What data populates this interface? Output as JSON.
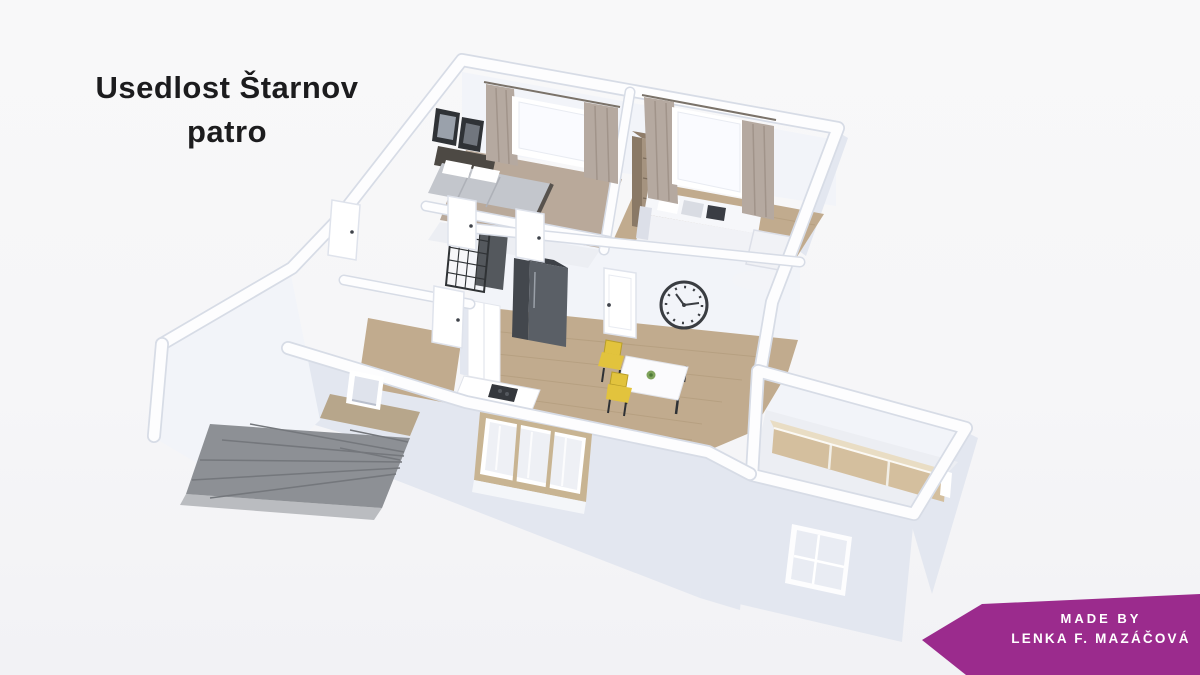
{
  "title": {
    "line1": "Usedlost Štarnov",
    "line2": "patro"
  },
  "credit": {
    "line1": "MADE BY",
    "line2": "LENKA F. MAZÁČOVÁ"
  },
  "scene": {
    "kind": "3d-floor-plan-render",
    "objects": [
      "double-bed",
      "wall-pictures",
      "curtained-windows",
      "bookcase",
      "corner-sofa",
      "rug",
      "glass-grid-partition",
      "wardrobe",
      "fridge",
      "kitchen-cabinets",
      "cooktop-counter",
      "dining-table",
      "yellow-chairs",
      "wall-clock",
      "interior-doors",
      "triple-front-window",
      "staircase",
      "small-wall-window",
      "wooden-sideboard",
      "storage-window"
    ]
  },
  "palette": {
    "bg": "#f6f6f8",
    "title": "#1c1c1e",
    "ribbon": "#9b2b8d",
    "ribbonText": "#ffffff",
    "wallTop": "#fdfdfe",
    "wallEdge": "#d7dce6",
    "faceLight": "#f2f4f9",
    "faceMid": "#e3e7f0",
    "faceDark": "#d2d7e3",
    "floorWood": "#c1ab8e",
    "floorWoodDark": "#a7906f",
    "floorPale": "#eceef3",
    "bedFloor": "#b9a99a",
    "stair": "#8d9095",
    "stairDark": "#74777c",
    "landing": "#b7a68b",
    "fridge": "#5a5f66",
    "fridgeDark": "#43474d",
    "wood": "#a5937f",
    "woodDark": "#8a7966",
    "curtain": "#b5a9a0",
    "curtainDark": "#a1948a",
    "sofa": "#f1f2f6",
    "sofaShadow": "#dcdfe8",
    "white": "#ffffff",
    "dark": "#2e3135",
    "chair": "#e2c33d",
    "clock": "#3a3d42",
    "sideboard": "#d4bf9e",
    "sideboardTop": "#e9ddc4",
    "glass": "#fafbff",
    "sheer": "#eef0f5"
  }
}
